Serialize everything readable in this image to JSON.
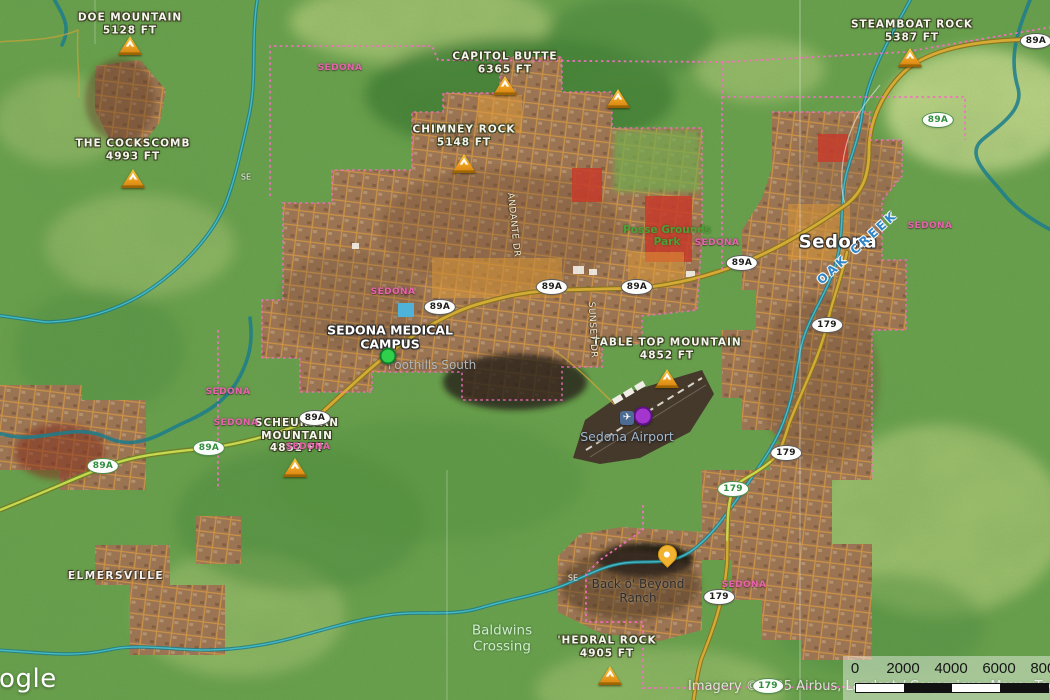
{
  "map": {
    "colors": {
      "terrain_green": "#6ba24d",
      "mesa_light": "#cede92",
      "forest_dark": "#3e7c33",
      "urban_brown": "#a07a58",
      "street_orange": "#d89a42",
      "creek_teal": "#2fa3ae",
      "highway_gold": "#d4ac35",
      "scenic_road_green": "#c6d84f",
      "boundary_pink": "#f46ec2",
      "red_zone": "#c63b2a"
    },
    "peaks": [
      {
        "name": "DOE MOUNTAIN",
        "elevation": "5128 FT",
        "x": 130,
        "y": 24,
        "icon_x": 130,
        "icon_y": 46
      },
      {
        "name": "THE COCKSCOMB",
        "elevation": "4993 FT",
        "x": 133,
        "y": 150,
        "icon_x": 133,
        "icon_y": 179
      },
      {
        "name": "CAPITOL BUTTE",
        "elevation": "6365 FT",
        "x": 505,
        "y": 63,
        "icon_x": 505,
        "icon_y": 86
      },
      {
        "name": "CHIMNEY ROCK",
        "elevation": "5148 FT",
        "x": 464,
        "y": 136,
        "icon_x": 464,
        "icon_y": 164
      },
      {
        "name": "STEAMBOAT ROCK",
        "elevation": "5387 FT",
        "x": 912,
        "y": 31,
        "icon_x": 910,
        "icon_y": 58
      },
      {
        "name": "TABLE TOP MOUNTAIN",
        "elevation": "4852 FT",
        "x": 667,
        "y": 349,
        "icon_x": 667,
        "icon_y": 379
      },
      {
        "name": "SCHEURMAN MOUNTAIN",
        "elevation": "4852 FT",
        "x": 297,
        "y": 436,
        "icon_x": 295,
        "icon_y": 468,
        "wrap": true
      },
      {
        "name": "'HEDRAL ROCK",
        "elevation": "4905 FT",
        "x": 607,
        "y": 647,
        "icon_x": 610,
        "icon_y": 676
      }
    ],
    "unlabeled_peaks": [
      {
        "x": 618,
        "y": 99
      }
    ],
    "boundary_labels": [
      {
        "text": "SEDONA",
        "x": 340,
        "y": 68
      },
      {
        "text": "SEDONA",
        "x": 393,
        "y": 292
      },
      {
        "text": "SEDONA",
        "x": 930,
        "y": 226
      },
      {
        "text": "SEDONA",
        "x": 717,
        "y": 243
      },
      {
        "text": "SEDONA",
        "x": 228,
        "y": 392
      },
      {
        "text": "SEDONA",
        "x": 236,
        "y": 423
      },
      {
        "text": "SEDONA",
        "x": 308,
        "y": 447
      },
      {
        "text": "SEDONA",
        "x": 744,
        "y": 585
      }
    ],
    "shields": [
      {
        "text": "89A",
        "x": 1036,
        "y": 41,
        "variant": "dark"
      },
      {
        "text": "89A",
        "x": 742,
        "y": 263,
        "variant": "dark"
      },
      {
        "text": "89A",
        "x": 552,
        "y": 287,
        "variant": "dark"
      },
      {
        "text": "89A",
        "x": 637,
        "y": 287,
        "variant": "dark"
      },
      {
        "text": "89A",
        "x": 440,
        "y": 307,
        "variant": "dark"
      },
      {
        "text": "89A",
        "x": 315,
        "y": 418,
        "variant": "dark"
      },
      {
        "text": "89A",
        "x": 938,
        "y": 120,
        "variant": "green"
      },
      {
        "text": "89A",
        "x": 209,
        "y": 448,
        "variant": "green"
      },
      {
        "text": "89A",
        "x": 103,
        "y": 466,
        "variant": "green"
      },
      {
        "text": "179",
        "x": 827,
        "y": 325,
        "variant": "dark"
      },
      {
        "text": "179",
        "x": 786,
        "y": 453,
        "variant": "dark"
      },
      {
        "text": "179",
        "x": 719,
        "y": 597,
        "variant": "dark"
      },
      {
        "text": "179",
        "x": 733,
        "y": 489,
        "variant": "green"
      },
      {
        "text": "179",
        "x": 768,
        "y": 686,
        "variant": "green"
      }
    ],
    "labels": [
      {
        "lines": [
          "SEDONA MEDICAL",
          "CAMPUS"
        ],
        "cls": "poi-bold",
        "name": "sedona-medical-campus-label",
        "x": 390,
        "y": 338
      },
      {
        "lines": [
          "Sedona"
        ],
        "cls": "city",
        "name": "sedona-city-label",
        "x": 838,
        "y": 243
      },
      {
        "lines": [
          "Sedona Airport"
        ],
        "cls": "airport",
        "name": "sedona-airport-label",
        "x": 627,
        "y": 437
      },
      {
        "lines": [
          "Posse Grounds",
          "Park"
        ],
        "cls": "park",
        "name": "posse-grounds-park-label",
        "x": 667,
        "y": 236
      },
      {
        "lines": [
          "Foothills South"
        ],
        "cls": "hood",
        "name": "foothills-south-label",
        "x": 432,
        "y": 366
      },
      {
        "lines": [
          "Baldwins",
          "Crossing"
        ],
        "cls": "water-place",
        "name": "baldwins-crossing-label",
        "x": 502,
        "y": 639
      },
      {
        "lines": [
          "Back o' Beyond",
          "Ranch"
        ],
        "cls": "ranch",
        "name": "back-o-beyond-ranch-label",
        "x": 638,
        "y": 592
      },
      {
        "lines": [
          "ELMERSVILLE"
        ],
        "cls": "settlement",
        "name": "elmersville-label",
        "x": 116,
        "y": 576
      },
      {
        "lines": [
          "OAK CREEK"
        ],
        "cls": "water",
        "name": "oak-creek-label",
        "x": 858,
        "y": 248,
        "rot": -42
      },
      {
        "lines": [
          "ANDANTE DR"
        ],
        "cls": "road",
        "name": "andante-dr-label",
        "x": 513,
        "y": 225,
        "rot": 84
      },
      {
        "lines": [
          "SUNSET DR"
        ],
        "cls": "road",
        "name": "sunset-dr-label",
        "x": 592,
        "y": 330,
        "rot": 87
      },
      {
        "lines": [
          "SE"
        ],
        "cls": "roadsm",
        "name": "road-fragment-label",
        "x": 246,
        "y": 177
      },
      {
        "lines": [
          "SE"
        ],
        "cls": "roadsm",
        "name": "road-fragment-label",
        "x": 573,
        "y": 578
      }
    ],
    "markers": [
      {
        "type": "dot",
        "name": "sedona-medical-campus-marker",
        "x": 388,
        "y": 356,
        "size": 13,
        "fill": "#2fd14c",
        "stroke": "#157a2e"
      },
      {
        "type": "dot",
        "name": "airport-marker",
        "x": 643,
        "y": 416,
        "size": 15,
        "fill": "#a435cf",
        "stroke": "#5f1287"
      },
      {
        "type": "pin",
        "name": "dropped-pin",
        "x": 666,
        "y": 562,
        "fill": "#f2b430",
        "stroke": "#d89c14"
      },
      {
        "type": "airport-icon",
        "name": "airport-icon",
        "x": 627,
        "y": 418,
        "glyph": "✈"
      }
    ],
    "scale_bar": {
      "ticks": [
        "0",
        "2000",
        "4000",
        "6000",
        "8000"
      ]
    },
    "attribution": "Imagery ©2025 Airbus, Landsat / Copernicus, Maxar Technologies",
    "logo": "Google"
  }
}
